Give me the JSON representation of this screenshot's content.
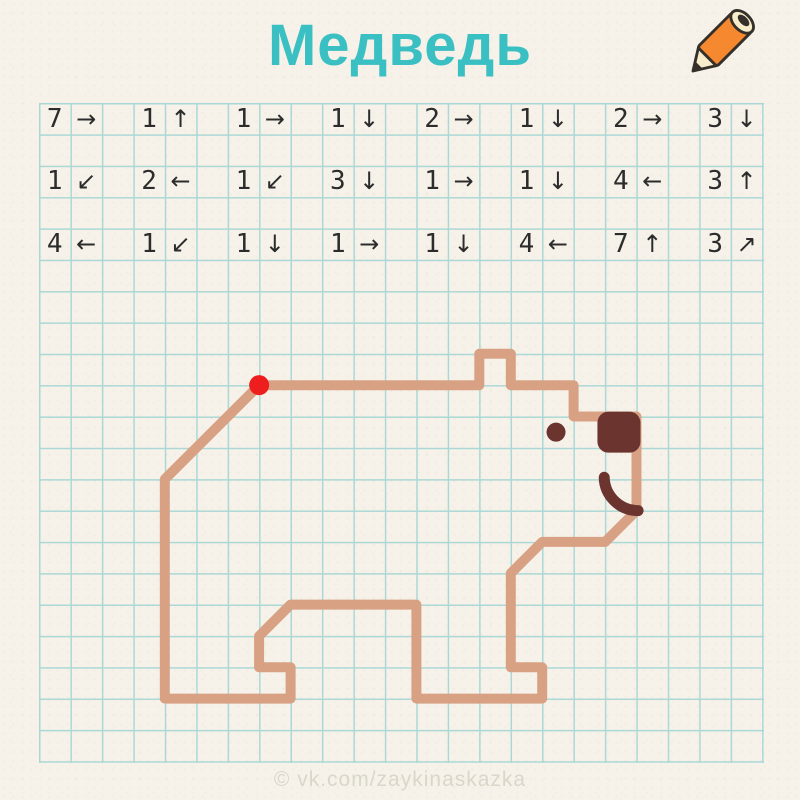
{
  "title": "Медведь",
  "watermark": "© vk.com/zaykinaskazka",
  "colors": {
    "paper": "#f6f2e9",
    "grid": "#abd8d6",
    "title": "#3abfc3",
    "text": "#2c2c2c",
    "line": "#d9a184",
    "dark": "#6b342e",
    "start_dot": "#ee1e1e",
    "watermark": "#d9d6ca",
    "pencil_orange": "#f6892f",
    "pencil_cream": "#f8edca",
    "pencil_outline": "#35302a"
  },
  "grid": {
    "origin_x": 39,
    "origin_y": 103,
    "cell_x": 31.45,
    "cell_y": 31.35,
    "cols": 23,
    "rows": 21
  },
  "instructions": {
    "rows": [
      [
        {
          "n": "7",
          "dir": "right",
          "arrow": "→"
        },
        {
          "n": "1",
          "dir": "up",
          "arrow": "↑"
        },
        {
          "n": "1",
          "dir": "right",
          "arrow": "→"
        },
        {
          "n": "1",
          "dir": "down",
          "arrow": "↓"
        },
        {
          "n": "2",
          "dir": "right",
          "arrow": "→"
        },
        {
          "n": "1",
          "dir": "down",
          "arrow": "↓"
        },
        {
          "n": "2",
          "dir": "right",
          "arrow": "→"
        },
        {
          "n": "3",
          "dir": "down",
          "arrow": "↓"
        }
      ],
      [
        {
          "n": "1",
          "dir": "down-left",
          "arrow": "↙"
        },
        {
          "n": "2",
          "dir": "left",
          "arrow": "←"
        },
        {
          "n": "1",
          "dir": "down-left",
          "arrow": "↙"
        },
        {
          "n": "3",
          "dir": "down",
          "arrow": "↓"
        },
        {
          "n": "1",
          "dir": "right",
          "arrow": "→"
        },
        {
          "n": "1",
          "dir": "down",
          "arrow": "↓"
        },
        {
          "n": "4",
          "dir": "left",
          "arrow": "←"
        },
        {
          "n": "3",
          "dir": "up",
          "arrow": "↑"
        }
      ],
      [
        {
          "n": "4",
          "dir": "left",
          "arrow": "←"
        },
        {
          "n": "1",
          "dir": "down-left",
          "arrow": "↙"
        },
        {
          "n": "1",
          "dir": "down",
          "arrow": "↓"
        },
        {
          "n": "1",
          "dir": "right",
          "arrow": "→"
        },
        {
          "n": "1",
          "dir": "down",
          "arrow": "↓"
        },
        {
          "n": "4",
          "dir": "left",
          "arrow": "←"
        },
        {
          "n": "7",
          "dir": "up",
          "arrow": "↑"
        },
        {
          "n": "3",
          "dir": "up-right",
          "arrow": "↗"
        }
      ]
    ]
  },
  "drawing": {
    "outline": [
      [
        7,
        9
      ],
      [
        14,
        9
      ],
      [
        14,
        8
      ],
      [
        15,
        8
      ],
      [
        15,
        9
      ],
      [
        17,
        9
      ],
      [
        17,
        10
      ],
      [
        19,
        10
      ],
      [
        19,
        13
      ],
      [
        18,
        14
      ],
      [
        16,
        14
      ],
      [
        15,
        15
      ],
      [
        15,
        18
      ],
      [
        16,
        18
      ],
      [
        16,
        19
      ],
      [
        12,
        19
      ],
      [
        12,
        16
      ],
      [
        8,
        16
      ],
      [
        7,
        17
      ],
      [
        7,
        18
      ],
      [
        8,
        18
      ],
      [
        8,
        19
      ],
      [
        4,
        19
      ],
      [
        4,
        12
      ]
    ],
    "start": [
      7,
      9
    ],
    "start_radius": 10,
    "eye": {
      "c": 16.44,
      "r": 10.5,
      "radius": 9.5
    },
    "nose": {
      "c": 18.44,
      "r": 10.5,
      "w": 43,
      "h": 41,
      "corner": 11
    },
    "mouth": {
      "start": [
        17.97,
        11.94
      ],
      "end": [
        19.05,
        13.0
      ],
      "radius": 34
    }
  }
}
